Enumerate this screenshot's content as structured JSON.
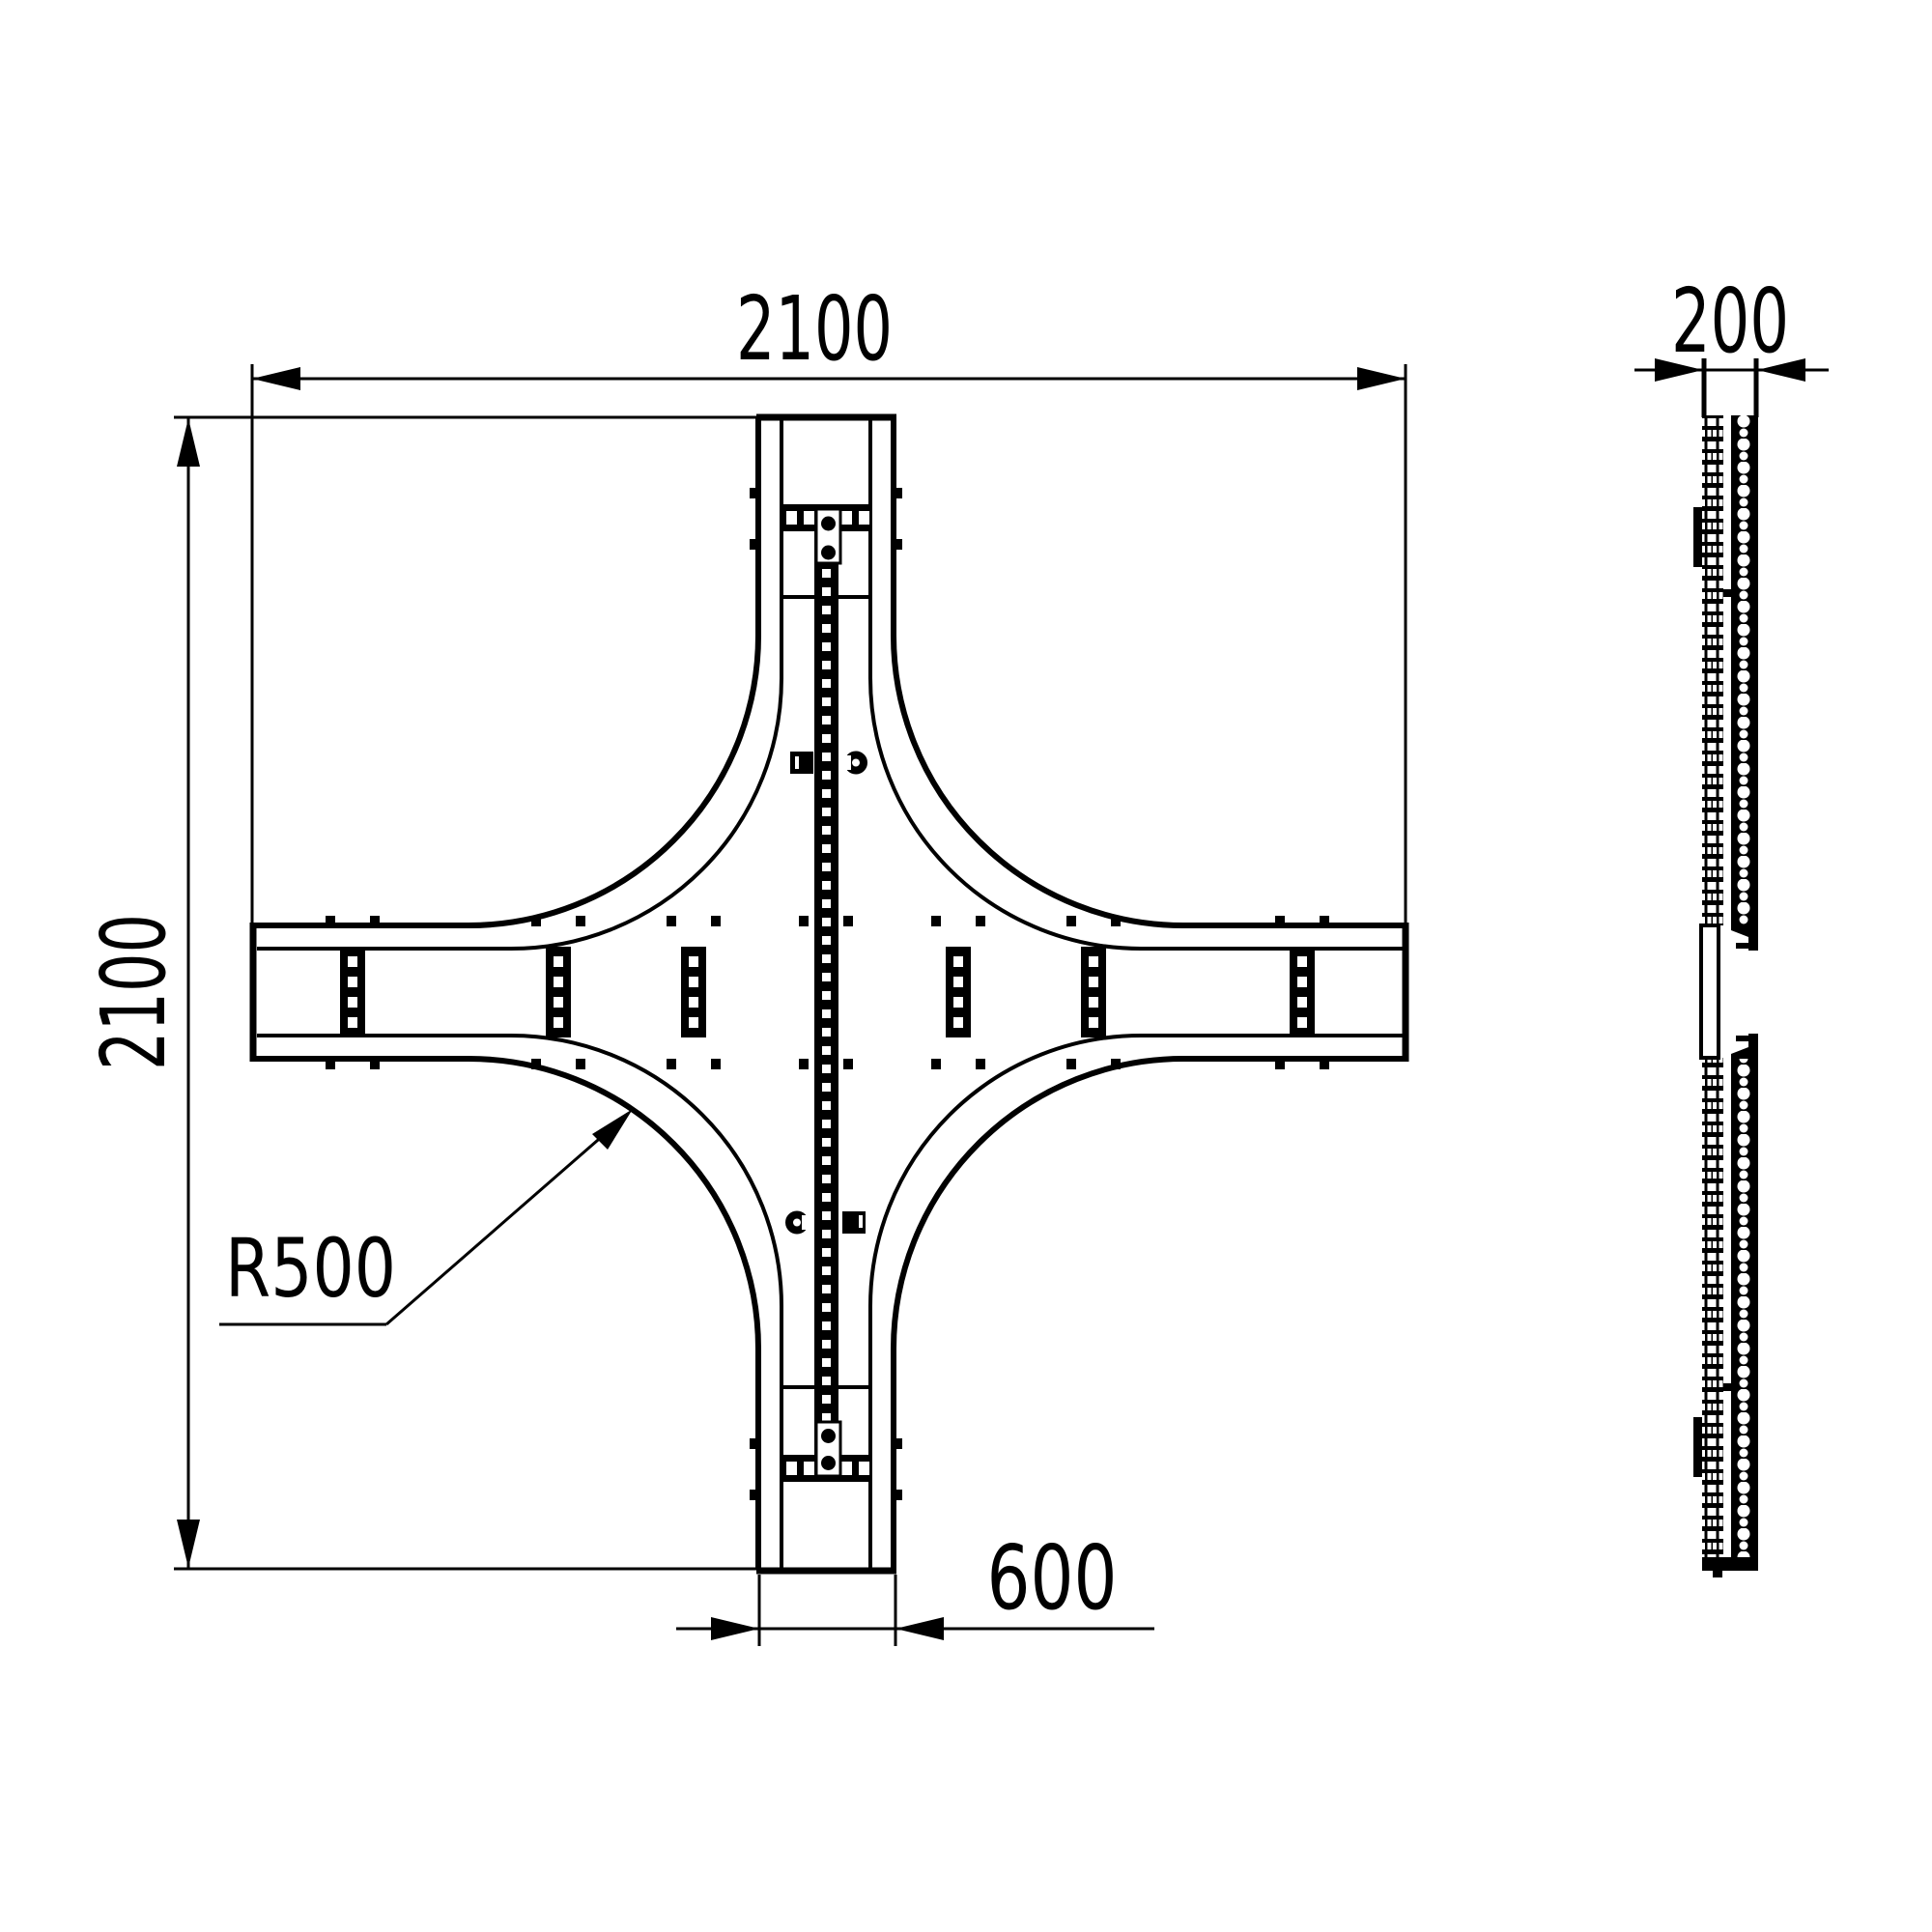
{
  "drawing": {
    "title": "cable-ladder-cross-piece-technical-drawing",
    "views": {
      "plan_view": "cross / intersection piece (top view)",
      "side_view": "profile (side view)"
    },
    "dimensions": {
      "top_width": "2100",
      "left_height": "2100",
      "branch_width": "600",
      "side_thickness": "200",
      "fillet_radius": "R500"
    },
    "colors": {
      "line": "#000000",
      "background": "#ffffff"
    }
  }
}
